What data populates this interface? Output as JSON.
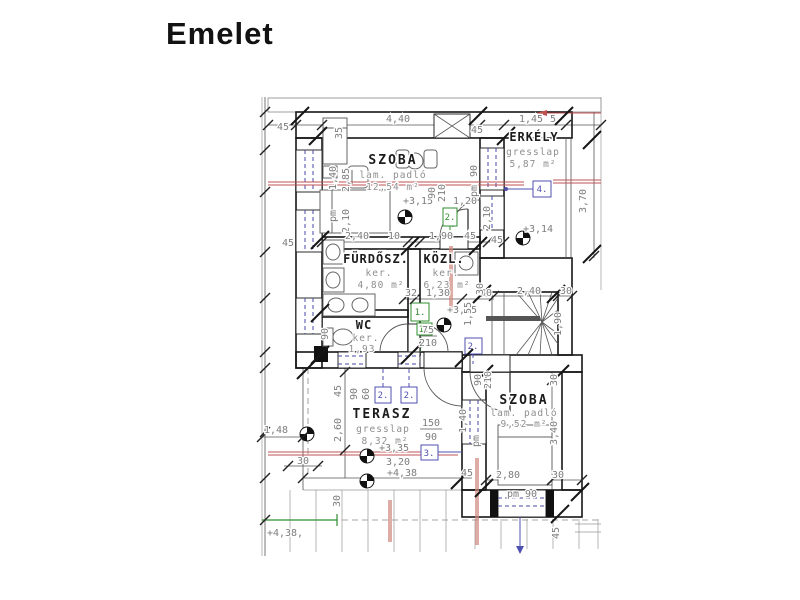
{
  "title": "Emelet",
  "colors": {
    "wall": "#161616",
    "section_line": "#c05050",
    "tag_green": "#2f8f2f",
    "tag_blue": "#5050b0",
    "dim_text": "#7d7d7d"
  },
  "rooms": [
    {
      "name": "SZOBA",
      "floor": "lam. padló",
      "area": "12,54 m²"
    },
    {
      "name": "ERKÉLY",
      "floor": "gresslap",
      "area": "5,87 m²"
    },
    {
      "name": "FÜRDŐSZ.",
      "floor": "ker.",
      "area": "4,80 m²"
    },
    {
      "name": "KÖZL.",
      "floor": "ker.",
      "area": "6,23 m²"
    },
    {
      "name": "WC",
      "floor": "ker.",
      "area": "1,93"
    },
    {
      "name": "TERASZ",
      "floor": "gresslap",
      "area": "8,32 m²"
    },
    {
      "name": "SZOBA",
      "floor": "lam. padló",
      "area": "9,52 m²"
    }
  ],
  "levels": {
    "szoba1": "+3,15",
    "kozl": "+3,15",
    "erkely": "+3,14",
    "terasz": "+3,35",
    "terasz_edge": "+4,38",
    "ground": "+4,38,"
  },
  "tags": {
    "door_szoba1": "2.",
    "door_furdo": "1.",
    "door_wc": "1.",
    "win_a": "2.",
    "win_b": "2.",
    "win_c": "2.",
    "win_terasz": "3.",
    "door_erkely": "4."
  },
  "dims": {
    "top_45l": "45",
    "top_440": "4,40",
    "top_45r": "45",
    "top_145": "1,45",
    "top_5": "5",
    "top_35": "35",
    "lw_140": "1,40",
    "lw_285": "2,85",
    "lw_pm": "pm",
    "lw_210": "2,10",
    "lw_45": "45",
    "lw_90": "90",
    "f_240": "2,40",
    "f_10": "10",
    "k_190": "1,90",
    "k_45": "45",
    "d1_90": "90",
    "d1_210": "210",
    "s1_120": "1,20",
    "bal_90": "90",
    "bal_pm": "pm",
    "bal_210": "2,10",
    "bal_45": "45",
    "m_32": "32",
    "m_130": "1,30",
    "m_40": "40",
    "m_75": "75",
    "m_210": "210",
    "st_240": "2,40",
    "st_30": "30",
    "st_30v": "30",
    "st_155": "1,55",
    "st_190": "1,90",
    "e_370": "3,70",
    "te_45": "45",
    "te_260": "2,60",
    "te_90": "90",
    "te_60": "60",
    "te_150": "150",
    "te_90b": "90",
    "te_320": "3,20",
    "te_30": "30",
    "te_45b": "45",
    "bl_148": "1,48",
    "bl_30": "30",
    "s2_90": "90",
    "s2_210": "210",
    "s2_30t": "30",
    "s2_140": "1,40",
    "s2_pm": "pm",
    "s2_340": "3,40",
    "s2_280": "2,80",
    "s2_30b": "30",
    "s2_pm90": "pm 90",
    "s2_45": "45"
  }
}
